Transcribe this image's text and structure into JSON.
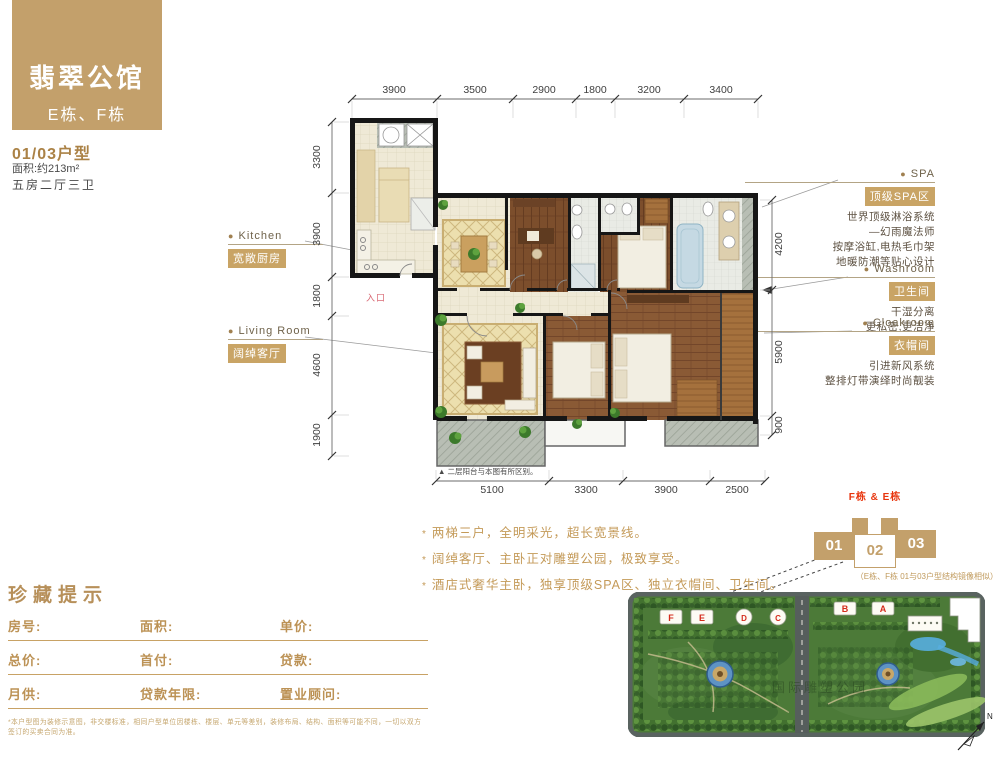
{
  "header": {
    "title": "翡翠公馆",
    "subtitle": "E栋、F栋",
    "unit_no": "01/03户型",
    "area": "面积:约213m²",
    "rooms": "五房二厅三卫"
  },
  "labels": {
    "kitchen": {
      "dot": "●",
      "en": "Kitchen",
      "zh": "宽敞厨房"
    },
    "living": {
      "dot": "●",
      "en": "Living Room",
      "zh": "阔绰客厅"
    },
    "spa": {
      "dot": "●",
      "en": "SPA",
      "zh": "顶级SPA区",
      "l1": "世界顶级淋浴系统",
      "l2": "—幻雨魔法师",
      "l3": "按摩浴缸,电热毛巾架",
      "l4": "地暖防潮等贴心设计"
    },
    "washroom": {
      "dot": "●",
      "en": "Washroom",
      "zh": "卫生间",
      "l1": "干湿分离",
      "l2": "更私密,更洁净"
    },
    "cloakroom": {
      "dot": "●",
      "en": "Cloakroom",
      "zh": "衣帽间",
      "l1": "引进新风系统",
      "l2": "整排灯带演绎时尚靓装"
    }
  },
  "plan": {
    "entrance": "入口",
    "note": "▲ 二层阳台与本图有所区别。",
    "dims_top": [
      "3900",
      "3500",
      "2900",
      "1800",
      "3200",
      "3400"
    ],
    "dims_left": [
      "3300",
      "3900",
      "1800",
      "4600",
      "1900"
    ],
    "dims_right": [
      "4200",
      "5900",
      "900"
    ],
    "dims_bottom": [
      "5100",
      "3300",
      "3900",
      "2500"
    ]
  },
  "features": [
    "两梯三户，全明采光，超长宽景线。",
    "阔绰客厅、主卧正对雕塑公园，极致享受。",
    "酒店式奢华主卧，独享顶级SPA区、独立衣帽间、卫生间。"
  ],
  "bullet": "*",
  "collection": {
    "title": "珍藏提示",
    "row1": {
      "c1": "房号:",
      "c2": "面积:",
      "c3": "单价:"
    },
    "row2": {
      "c1": "总价:",
      "c2": "首付:",
      "c3": "贷款:"
    },
    "row3": {
      "c1": "月供:",
      "c2": "贷款年限:",
      "c3": "置业顾问:"
    },
    "footnote": "*本户型图为装修示意图，非交楼标准，相同户型单位因楼栋、楼层、单元等差别，装修布局、结构、面积等可能不同，一切以双方签订的买卖合同为准。"
  },
  "diagram": {
    "label": "F栋 & E栋",
    "u1": "01",
    "u2": "02",
    "u3": "03",
    "caption": "（E栋、F栋 01与03户型结构镜像相似）"
  },
  "siteplan": {
    "watermark": "国际雕塑公园",
    "compass": "N",
    "b1": "F",
    "b2": "E",
    "b3": "D",
    "b4": "C",
    "b5": "B",
    "b6": "A"
  },
  "colors": {
    "gold": "#c3a06b",
    "gold_text": "#b7905a",
    "red": "#e8340c",
    "wood": "#8a5a35",
    "tile": "#ecdfae"
  }
}
